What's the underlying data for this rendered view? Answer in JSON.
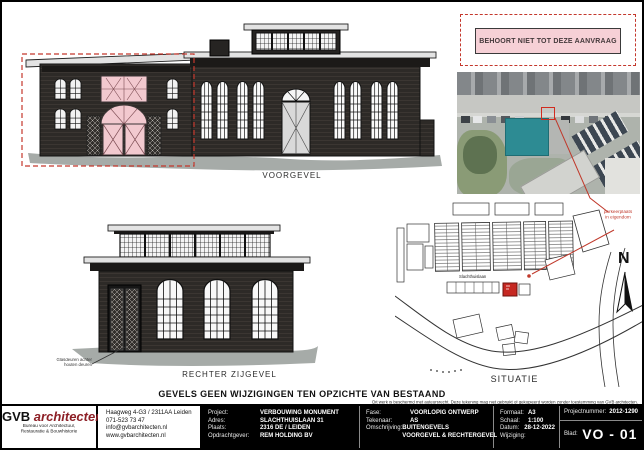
{
  "sheet": {
    "not_in_application": "BEHOORT NIET TOT DEZE AANVRAAG",
    "main_note": "GEVELS GEEN WIJZIGINGEN TEN OPZICHTE VAN BESTAAND",
    "copyright": "Dit werk is beschermd met auteursrecht. Deze tekening mag niet gebruikt of gekopieerd worden zonder toestemming van GVB architecten."
  },
  "drawings": {
    "front_elevation": {
      "label": "VOORGEVEL"
    },
    "right_elevation": {
      "label": "RECHTER ZIJGEVEL",
      "annotation_line1": "Glasdeuren achter",
      "annotation_line2": "houten deuren"
    },
    "site_plan": {
      "label": "SITUATIE",
      "street_label": "Slachthuislaan",
      "annotation_line1": "parkeerplaats",
      "annotation_line2": "in eigendom",
      "north_label": "N"
    }
  },
  "title_block": {
    "firm": {
      "name_bold": "GVB",
      "name_italic": "architecten",
      "subtitle_line1": "Bureau voor Architectuur,",
      "subtitle_line2": "Restauratie & Bouwhistorie"
    },
    "contact": {
      "address": "Haagweg 4-G3  / 2311AA Leiden",
      "phone": "071-523 73 47",
      "email": "info@gvbarchitecten.nl",
      "website": "www.gvbarchitecten.nl"
    },
    "project": {
      "label_project": "Project:",
      "value_project": "VERBOUWING MONUMENT",
      "label_adres": "Adres:",
      "value_adres": "SLACHTHUISLAAN 31",
      "label_plaats": "Plaats:",
      "value_plaats": "2316 DE / LEIDEN",
      "label_opdrachtgever": "Opdrachtgever:",
      "value_opdrachtgever": "REM HOLDING BV"
    },
    "phase": {
      "label_fase": "Fase:",
      "value_fase": "VOORLOPIG ONTWERP",
      "label_tekenaar": "Tekenaar:",
      "value_tekenaar": "AS",
      "label_omschrijving": "Omschrijving:",
      "value_omschrijving1": "BUITENGEVELS",
      "value_omschrijving2": "VOORGEVEL & RECHTERGEVEL"
    },
    "format": {
      "label_formaat": "Formaat:",
      "value_formaat": "A3",
      "label_schaal": "Schaal:",
      "value_schaal": "1:100",
      "label_datum": "Datum:",
      "value_datum": "28-12-2022",
      "label_wijziging": "Wijziging:",
      "value_wijziging": ""
    },
    "sheet_no": {
      "label_projectnummer": "Projectnummer:",
      "value_projectnummer": "2012-1290",
      "label_blad": "Blad:",
      "value_blad": "VO -  01"
    }
  },
  "colors": {
    "accent_red": "#c0392b",
    "highlight_pink": "#f2c9cf",
    "wall_dark": "#2d2a27",
    "site_red": "#c62822",
    "teal_roof": "#2d8b93"
  }
}
